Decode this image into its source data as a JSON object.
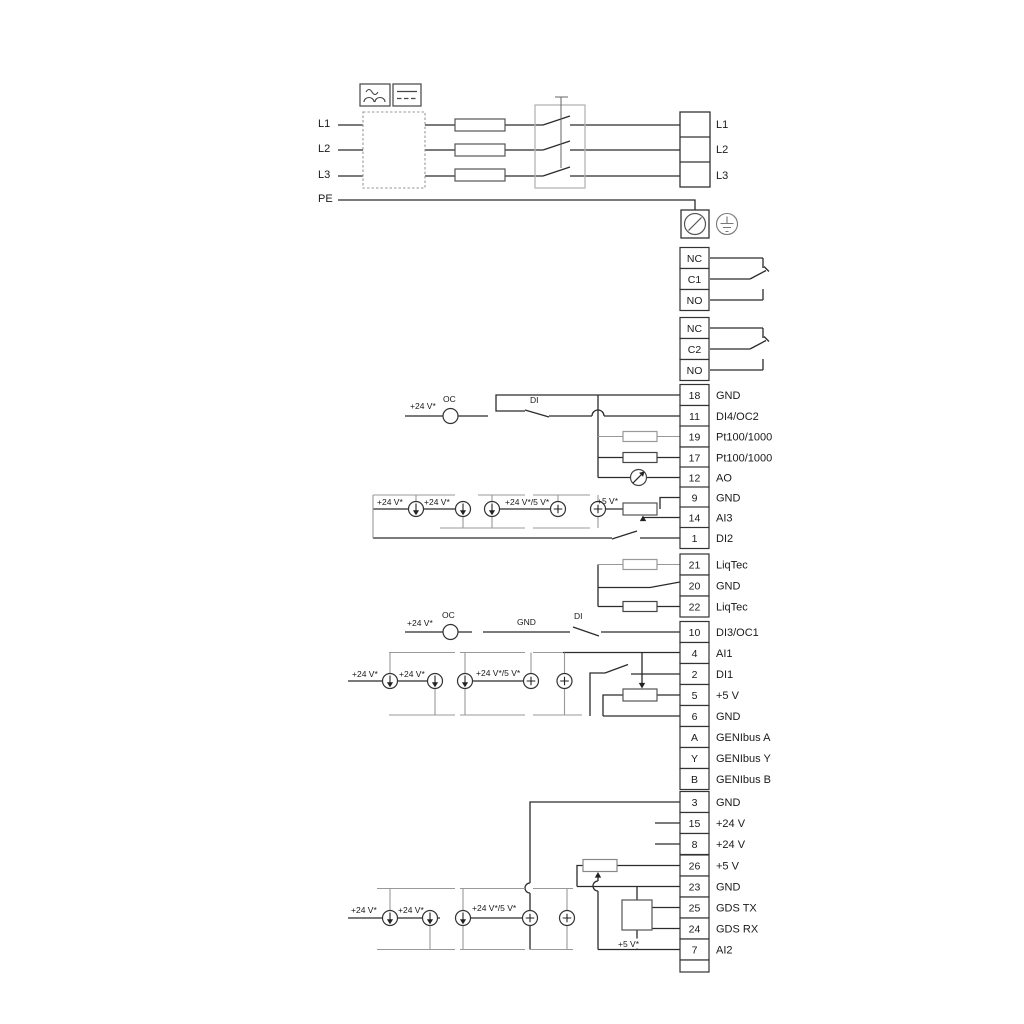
{
  "diagram": {
    "power_inputs": [
      "L1",
      "L2",
      "L3",
      "PE"
    ],
    "power_outputs": [
      "L1",
      "L2",
      "L3"
    ],
    "relay_cells": [
      "NC",
      "C1",
      "NO",
      "NC",
      "C2",
      "NO"
    ],
    "terminals": [
      {
        "num": "18",
        "label": "GND"
      },
      {
        "num": "11",
        "label": "DI4/OC2"
      },
      {
        "num": "19",
        "label": "Pt100/1000"
      },
      {
        "num": "17",
        "label": "Pt100/1000"
      },
      {
        "num": "12",
        "label": "AO"
      },
      {
        "num": "9",
        "label": "GND"
      },
      {
        "num": "14",
        "label": "AI3"
      },
      {
        "num": "1",
        "label": "DI2"
      },
      {
        "num": "21",
        "label": "LiqTec"
      },
      {
        "num": "20",
        "label": "GND"
      },
      {
        "num": "22",
        "label": "LiqTec"
      },
      {
        "num": "10",
        "label": "DI3/OC1"
      },
      {
        "num": "4",
        "label": "AI1"
      },
      {
        "num": "2",
        "label": "DI1"
      },
      {
        "num": "5",
        "label": "+5 V"
      },
      {
        "num": "6",
        "label": "GND"
      },
      {
        "num": "A",
        "label": "GENIbus A"
      },
      {
        "num": "Y",
        "label": "GENIbus Y"
      },
      {
        "num": "B",
        "label": "GENIbus B"
      },
      {
        "num": "3",
        "label": "GND"
      },
      {
        "num": "15",
        "label": "+24 V"
      },
      {
        "num": "8",
        "label": "+24 V"
      },
      {
        "num": "26",
        "label": "+5 V"
      },
      {
        "num": "23",
        "label": "GND"
      },
      {
        "num": "25",
        "label": "GDS TX"
      },
      {
        "num": "24",
        "label": "GDS RX"
      },
      {
        "num": "7",
        "label": "AI2"
      }
    ],
    "annotations": {
      "v24": "+24 V*",
      "v24v5": "+24 V*/5 V*",
      "v5": "+5 V*",
      "oc": "OC",
      "di": "DI",
      "gnd": "GND"
    },
    "colors": {
      "wire": "#2b2b2b",
      "rail": "#999999"
    }
  }
}
